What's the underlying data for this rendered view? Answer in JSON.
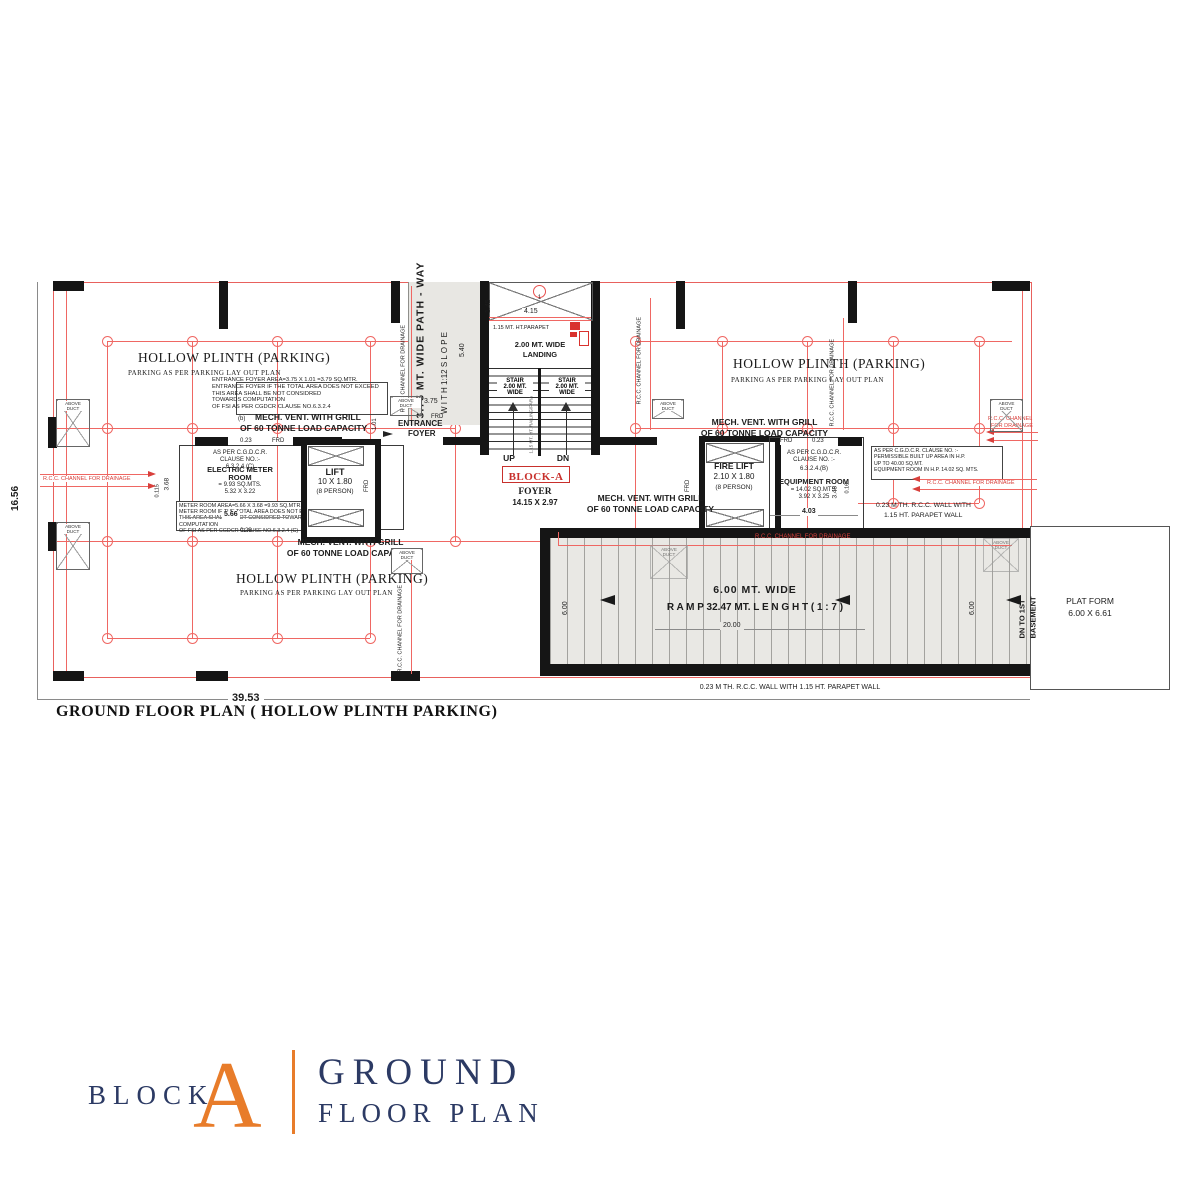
{
  "colors": {
    "red": "#e8504e",
    "navy": "#2c3a64",
    "orange": "#e87c2a",
    "gray_fill": "#e8e7e3"
  },
  "title_block": {
    "block": "BLOCK",
    "letter": "A",
    "l1": "GROUND",
    "l2": "FLOOR PLAN"
  },
  "plan": {
    "caption": "GROUND FLOOR PLAN ( HOLLOW PLINTH PARKING)",
    "zones": {
      "title": "HOLLOW PLINTH (PARKING)",
      "sub": "PARKING AS PER PARKING LAY OUT PLAN"
    },
    "dims": {
      "width": "39.53",
      "height": "16.56"
    },
    "pathway": {
      "line1": "3.75 MT. WIDE PATH - WAY",
      "line2": "W I T H    1:12 S L O P E",
      "slope_dim": "5.40",
      "width_dim": "3.75"
    },
    "stair": {
      "bubble": "1",
      "dim_v": "1.45",
      "dim_h": "4.15",
      "parapet": "1.15 MT. HT.PARAPET",
      "landing1": "2.00 MT. WIDE",
      "landing2": "LANDING",
      "s1": "STAIR",
      "s2": "2.00 MT.",
      "s3": "WIDE",
      "divider": "1.15 MT. HT. RAILING/PARAPET",
      "up": "UP",
      "dn": "DN",
      "block": "BLOCK-A",
      "foyer": "FOYER",
      "foyer_dim": "14.15 X 2.97"
    },
    "entrance": {
      "l1": "ENTRANCE",
      "l2": "FOYER",
      "dim": "1.01"
    },
    "entrance_note": {
      "n1": "ENTRANCE FOYER AREA=3.75 X 1.01 =3.79 SQ.MTR.",
      "n2": "ENTRANCE FOYER IF THE TOTAL AREA DOES NOT EXCEED",
      "n3": "THIS AREA SHALL BE NOT CONSIDRED",
      "n4": "TOWARDS COMPUTATION",
      "n5": "OF FSI AS PER  CGDCR CLAUSE NO.6.3.2.4",
      "b": "(b)"
    },
    "mech": {
      "l1": "MECH. VENT. WITH GRILL",
      "l2": "OF 60 TONNE LOAD CAPACITY"
    },
    "meter": {
      "c1": "AS PER C.G.D.C.R.",
      "c2": "CLAUSE NO.:-",
      "c3": "6.3.2.4.(C)",
      "name1": "ELECTRIC METER",
      "name2": "ROOM",
      "area": "= 9.93 SQ.MTS.",
      "size": "5.32 X 3.22",
      "n1": "METER ROOM AREA=5.66 X 3.68 =9.93 SQ.MTR.",
      "n2": "METER ROOM IF THE TOTAL AREA DOES NOT EXCEED SQ.mt",
      "n3": "THIS AREA SHALL BE NOT  CONSIDRED TOWARDS COMPUTATION",
      "n4": "OF FSI AS PER  CGDCR CLAUSE NO.6.3.2.4 (C)",
      "d_566": "5.66",
      "d_023": "0.23",
      "d_368": "3.68",
      "d_0115": "0.115"
    },
    "lift": {
      "name": "LIFT",
      "size": "10 X 1.80",
      "cap": "(8 PERSON)"
    },
    "fire_lift": {
      "name": "FIRE LIFT",
      "size": "2.10 X 1.80",
      "cap": "(8 PERSON)"
    },
    "equip": {
      "c1": "AS PER C.G.D.C.R.",
      "c2": "CLAUSE NO. :-",
      "c3": "6.3.2.4.(B)",
      "name": "EQUIPMENT ROOM",
      "area": "= 14.02 SQ.MTS.",
      "size": "3.92 X 3.25",
      "d_403": "4.03",
      "d_348": "3.48",
      "d_016": "0.16",
      "d_023": "0.23"
    },
    "hp_note": {
      "n1": "AS PER C.G.D.C.R. CLAUSE NO. :-",
      "n2": "PERMISSIBLE BUILT UP AREA IN H.P.",
      "n3": "UP TO 40.00 SQ.MT.",
      "n4": "EQUIPMENT ROOM IN H.P. 14.02 SQ. MTS."
    },
    "wall_note": {
      "r1": "0.23 M TH. R.C.C. WALL WITH",
      "r2": "1.15 HT. PARAPET WALL",
      "bottom": "0.23 M TH. R.C.C. WALL WITH 1.15 HT. PARAPET WALL"
    },
    "ramp": {
      "wide": "6.00 MT. WIDE",
      "len": "R A M P  32.47 MT.   L E N G H T  ( 1 : 7 )",
      "d_20": "20.00",
      "d_6": "6.00"
    },
    "platform": {
      "l1": "PLAT FORM",
      "l2": "6.00 X 6.61",
      "dn1": "DN TO 1ST",
      "dn2": "BASEMENT"
    },
    "misc": {
      "duct1": "ABOVE",
      "duct2": "DUCT",
      "frd": "FRD",
      "rcc": "R.C.C. CHANNEL FOR DRAINAGE",
      "rcc1": "R.C.C. CHANNEL",
      "rcc2": "FOR DRAINAGE"
    }
  }
}
